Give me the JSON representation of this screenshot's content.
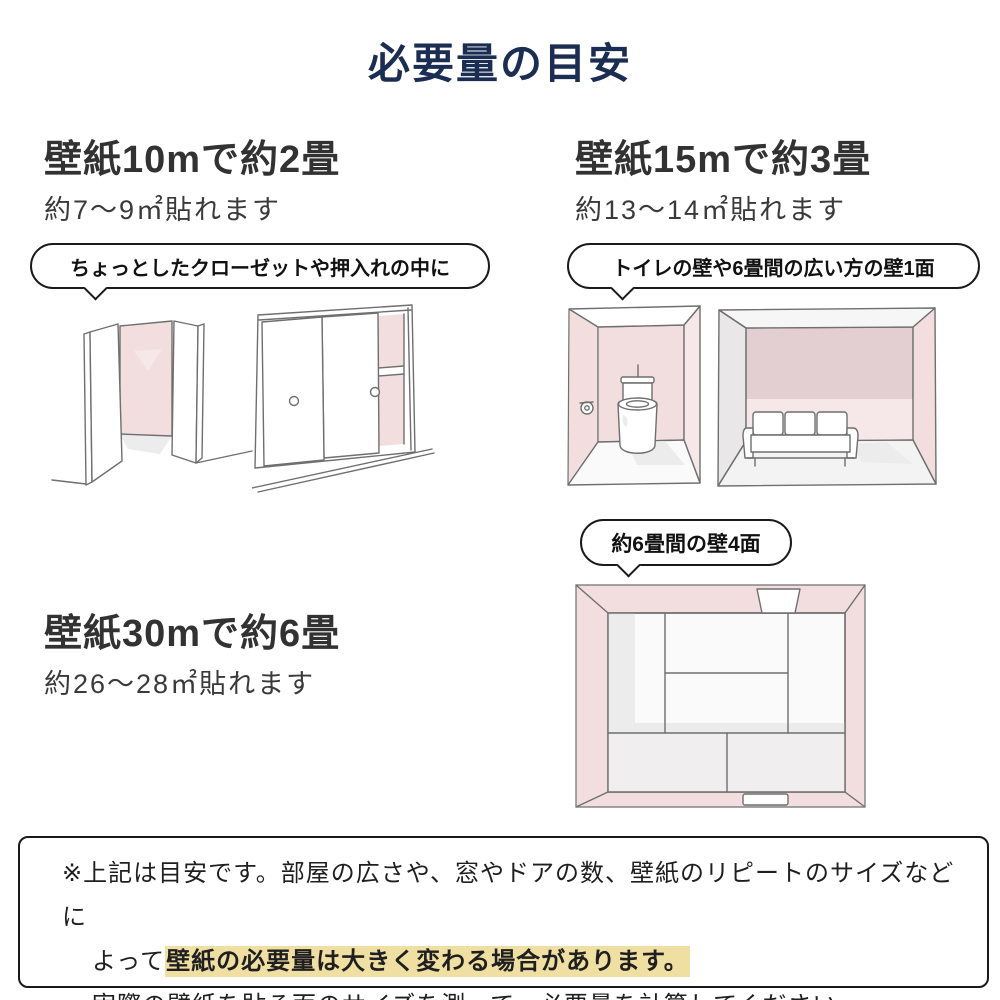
{
  "colors": {
    "navy": "#1b2d52",
    "txt": "#2f2f2f",
    "bdr": "#1a1a1a",
    "pink": "#f2dedf",
    "pinkL": "#f6e7e8",
    "pinkM": "#e3ced2",
    "grayW": "#e9e7e8",
    "grayF": "#ececec",
    "line": "#6f6f6f",
    "hl": "#f0dfa3"
  },
  "title": "必要量の目安",
  "sections": {
    "s10": {
      "heading": "壁紙10mで約2畳",
      "sub": "約7〜9㎡貼れます",
      "bubble": "ちょっとしたクローゼットや押入れの中に",
      "illustrations": [
        "open-closet-sketch",
        "sliding-closet-sketch"
      ]
    },
    "s15": {
      "heading": "壁紙15mで約3畳",
      "sub": "約13〜14㎡貼れます",
      "bubble": "トイレの壁や6畳間の広い方の壁1面",
      "illustrations": [
        "toilet-room-sketch",
        "living-room-sketch"
      ]
    },
    "s30": {
      "heading": "壁紙30mで約6畳",
      "sub": "約26〜28㎡貼れます",
      "bubble": "約6畳間の壁4面",
      "illustrations": [
        "six-mat-room-sketch"
      ]
    }
  },
  "footer": {
    "line1": "※上記は目安です。部屋の広さや、窓やドアの数、壁紙のリピートのサイズなどに",
    "line2_prefix": "よって",
    "line2_highlight": "壁紙の必要量は大きく変わる場合があります。",
    "line3": "実際の壁紙を貼る面のサイズを測って、必要量を計算してください。"
  }
}
